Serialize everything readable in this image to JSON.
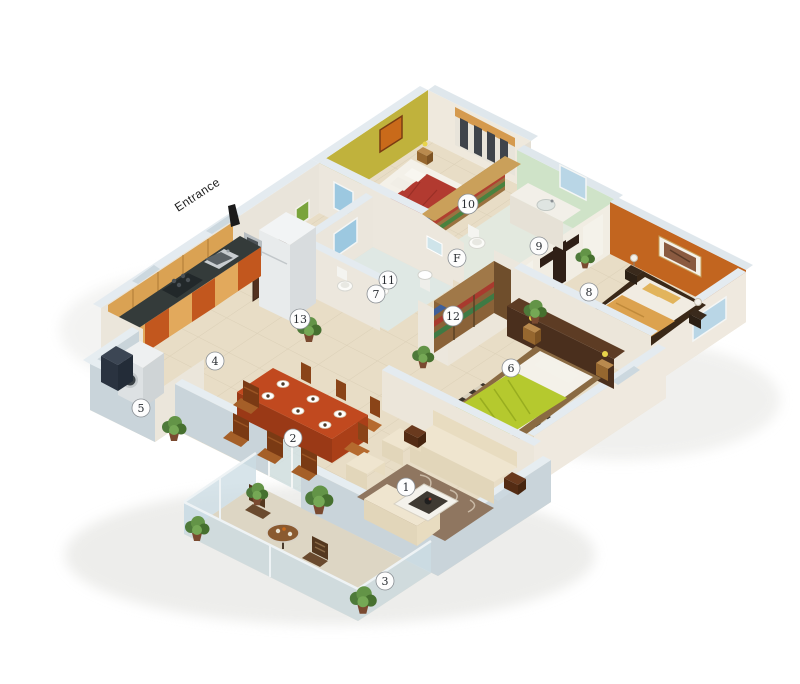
{
  "scene": {
    "type": "3d-isometric-floor-plan",
    "background": "#ffffff"
  },
  "entrance": {
    "label": "Entrance"
  },
  "markers": [
    {
      "label": "1"
    },
    {
      "label": "2"
    },
    {
      "label": "3"
    },
    {
      "label": "4"
    },
    {
      "label": "5"
    },
    {
      "label": "6"
    },
    {
      "label": "7"
    },
    {
      "label": "8"
    },
    {
      "label": "9"
    },
    {
      "label": "10"
    },
    {
      "label": "11"
    },
    {
      "label": "12"
    },
    {
      "label": "13"
    },
    {
      "label": "F"
    }
  ],
  "colors": {
    "floor": "#e8ddc6",
    "balcony_floor": "#ddd6c4",
    "outer_wall": "#c9d4da",
    "wall_top": "#e6edf1",
    "inner_wall": "#ece7dd",
    "yellow_wall": "#c0b23c",
    "orange_wall": "#c2651f",
    "green_wall": "#cfe3c8",
    "door": "#53311f",
    "red_bed": "#b23a30",
    "green_bed": "#b5c92e",
    "orange_bed": "#dca24f",
    "dining_table": "#c1491f",
    "kitchen_cabinet_orange": "#c2571e",
    "kitchen_cabinet_tan": "#e2a95c",
    "upper_cabinet": "#daa253",
    "rug_living": "#8f7660",
    "window_glass": "#9cc8e0",
    "plant_green": "#639447",
    "wood_dark": "#4a2f1d"
  }
}
